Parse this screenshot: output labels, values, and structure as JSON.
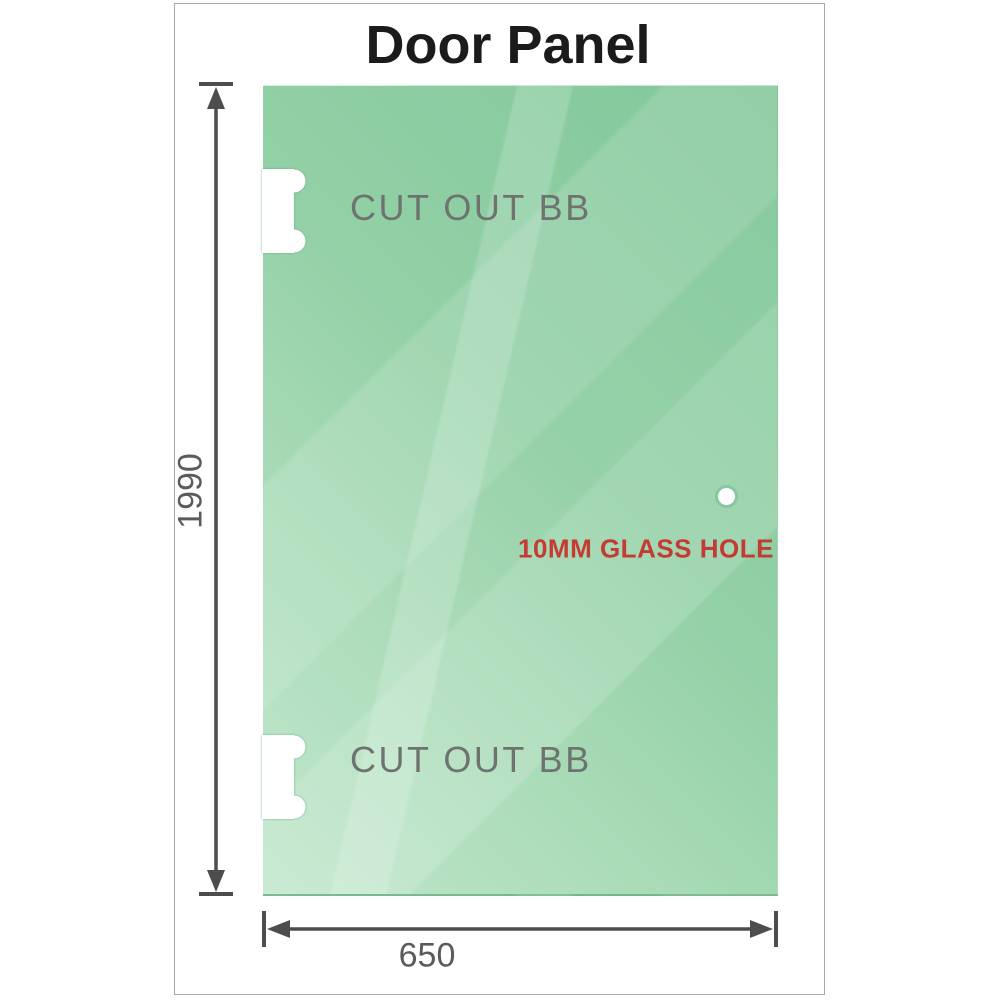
{
  "title": "Door Panel",
  "diagram": {
    "height_dimension": "1990",
    "width_dimension": "650",
    "cutouts": [
      {
        "label": "CUT OUT BB"
      },
      {
        "label": "CUT OUT BB"
      }
    ],
    "hole": {
      "label": "10MM GLASS HOLE"
    }
  },
  "colors": {
    "glass_dark": "#82c79b",
    "glass_light": "#c0e6cb",
    "dimension_line": "#4d4d4d",
    "dimension_text": "#5a5b5d",
    "cutout_text": "#6e736f",
    "hole_label_red": "#c33b32",
    "title_text": "#1b1b1b",
    "frame_border": "#a9a9a9"
  }
}
